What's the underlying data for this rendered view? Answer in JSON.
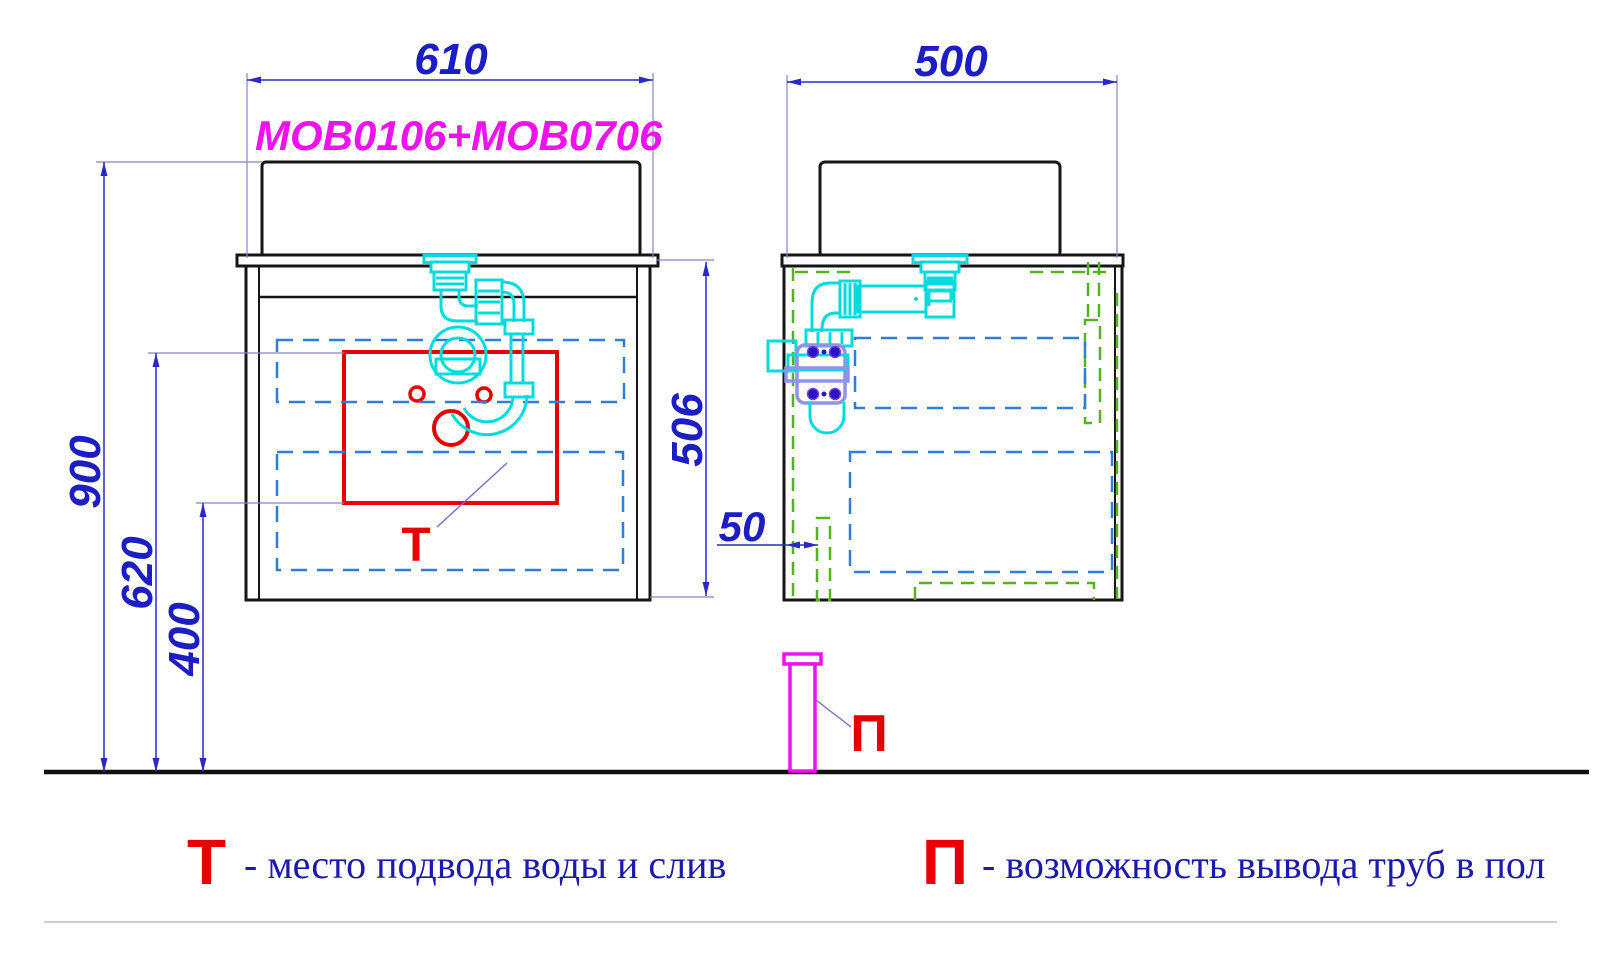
{
  "drawing": {
    "model_label": "MOB0106+MOB0706",
    "dimensions": {
      "front_width": "610",
      "side_depth": "500",
      "total_height": "900",
      "supply_height": "620",
      "drain_height": "400",
      "cabinet_height": "506",
      "back_offset": "50"
    },
    "markers": {
      "water_point": "Т",
      "floor_pipe": "П"
    }
  },
  "legend": {
    "water": {
      "symbol": "Т",
      "text": "- место подвода воды и слив"
    },
    "floor_pipes": {
      "symbol": "П",
      "text": "- возможность вывода труб в пол"
    }
  },
  "colors": {
    "dimension_blue": "#1d1dc4",
    "dashed_blue": "#2f7fd8",
    "dashed_green": "#55b320",
    "plumbing_cyan": "#00dcdc",
    "bracket_lavender": "#9292ea",
    "bolt_indigo": "#2812c6",
    "magenta": "#f012ee",
    "red": "#e60000",
    "legend_text_blue": "#1c1aae"
  }
}
